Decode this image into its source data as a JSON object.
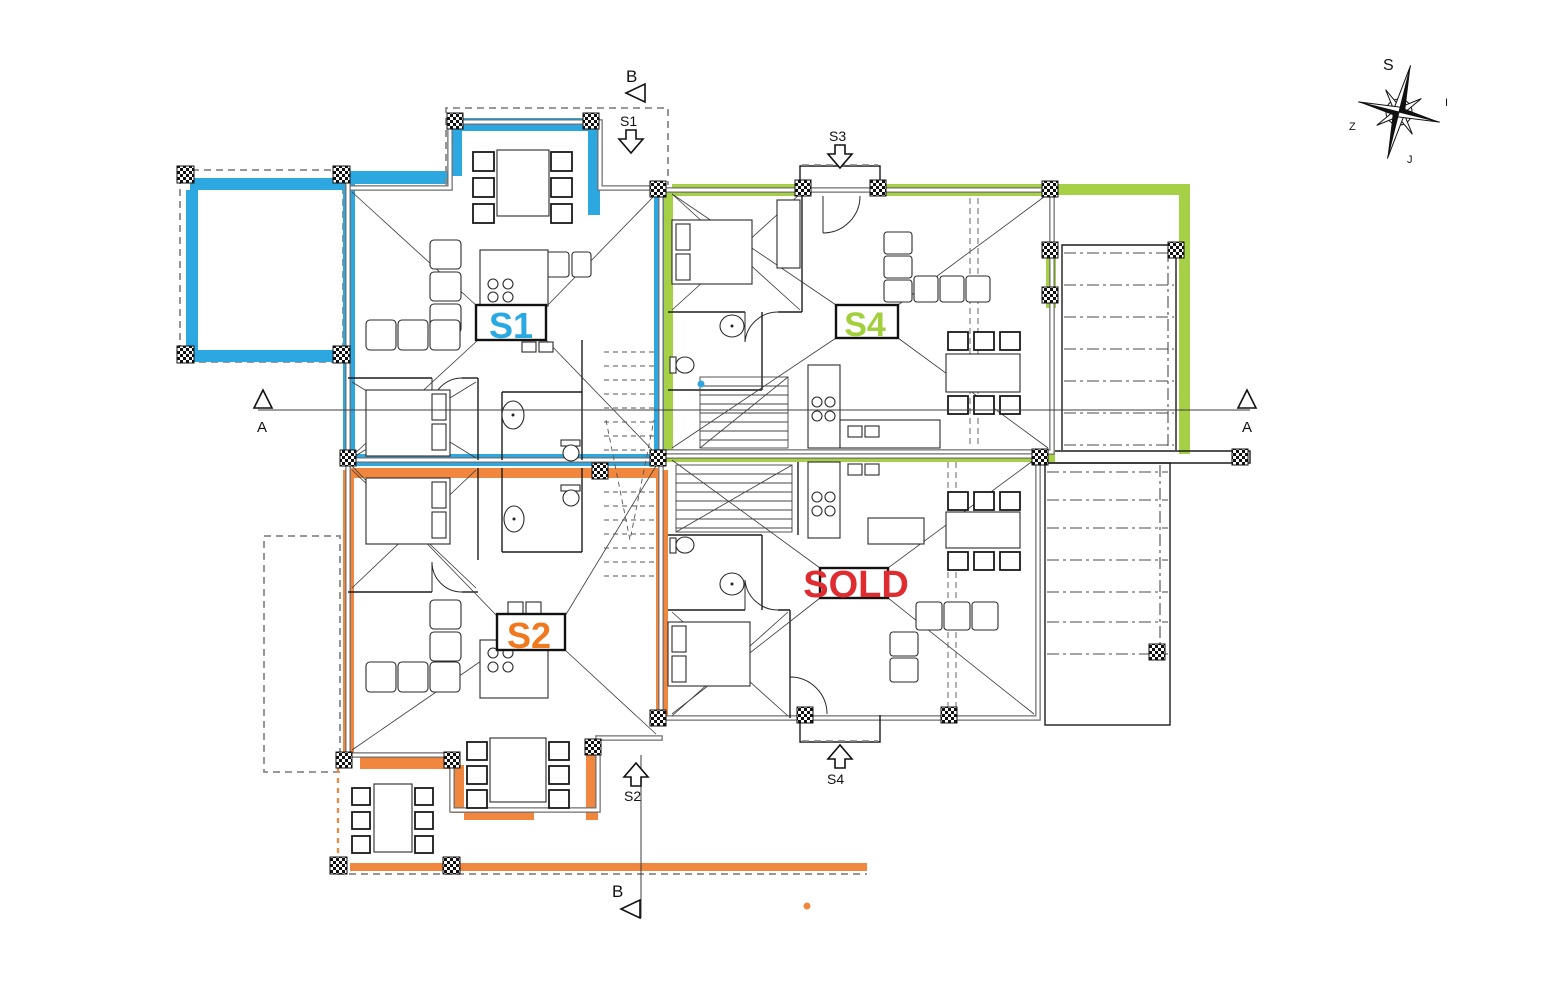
{
  "units": {
    "s1": {
      "label": "S1",
      "color": "#29a9e1"
    },
    "s2": {
      "label": "S2",
      "color": "#f0781e"
    },
    "s4": {
      "label": "S4",
      "color": "#a2cf3c"
    },
    "sold": {
      "label": "SOLD",
      "color": "#df2c31"
    }
  },
  "markers": {
    "section_a_left": "A",
    "section_a_right": "A",
    "section_b_top": "B",
    "section_b_bottom": "B",
    "entry_s1": "S1",
    "entry_s2": "S2",
    "entry_s3": "S3",
    "entry_s4": "S4"
  },
  "compass": {
    "north": "S",
    "east": "I",
    "west": "Z",
    "south": "J"
  },
  "colors": {
    "blue_band": "#2da7e0",
    "green_band": "#a6d045",
    "orange_band": "#f1873f",
    "sold_red": "#df2c31",
    "wall_gray": "#6f6f6f"
  }
}
